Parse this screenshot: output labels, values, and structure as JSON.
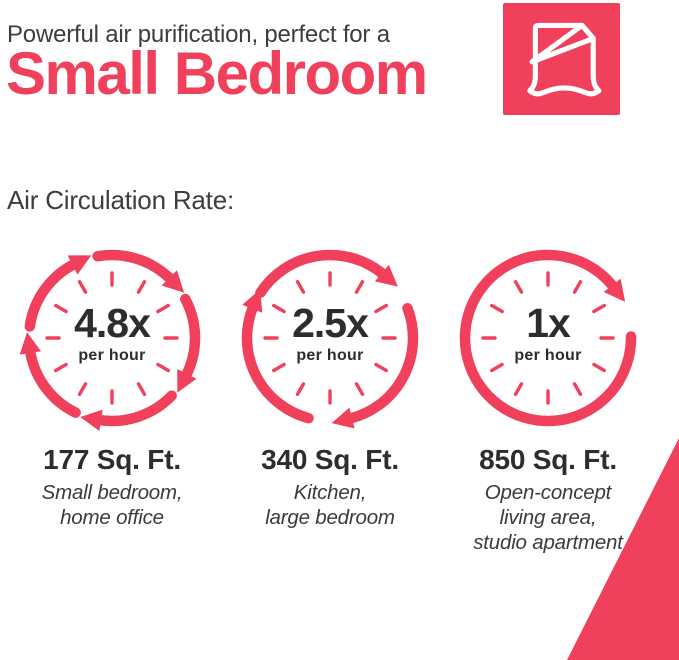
{
  "colors": {
    "accent": "#F0405C",
    "heading_text": "#3D3D3D",
    "number_text": "#2D2D2D",
    "subtitle_text": "#3B3B3B",
    "background": "#FFFFFF",
    "icon_stroke": "#FFFFFF"
  },
  "header": {
    "tagline": "Powerful air purification, perfect for a",
    "title": "Small Bedroom",
    "badge_icon": "bed-duvet-icon"
  },
  "section": {
    "label": "Air Circulation Rate:"
  },
  "chart_data": {
    "type": "pictogram",
    "title": "Air Circulation Rate:",
    "items": [
      {
        "rate": "4.8x",
        "rate_value": 4.8,
        "unit": "per hour",
        "area": "177 Sq. Ft.",
        "area_sqft": 177,
        "rooms": "Small bedroom,\nhome office",
        "arrow_count": 5
      },
      {
        "rate": "2.5x",
        "rate_value": 2.5,
        "unit": "per hour",
        "area": "340 Sq. Ft.",
        "area_sqft": 340,
        "rooms": "Kitchen,\nlarge bedroom",
        "arrow_count": 3
      },
      {
        "rate": "1x",
        "rate_value": 1,
        "unit": "per hour",
        "area": "850 Sq. Ft.",
        "area_sqft": 850,
        "rooms": "Open-concept\nliving area,\nstudio apartment",
        "arrow_count": 1
      }
    ]
  }
}
